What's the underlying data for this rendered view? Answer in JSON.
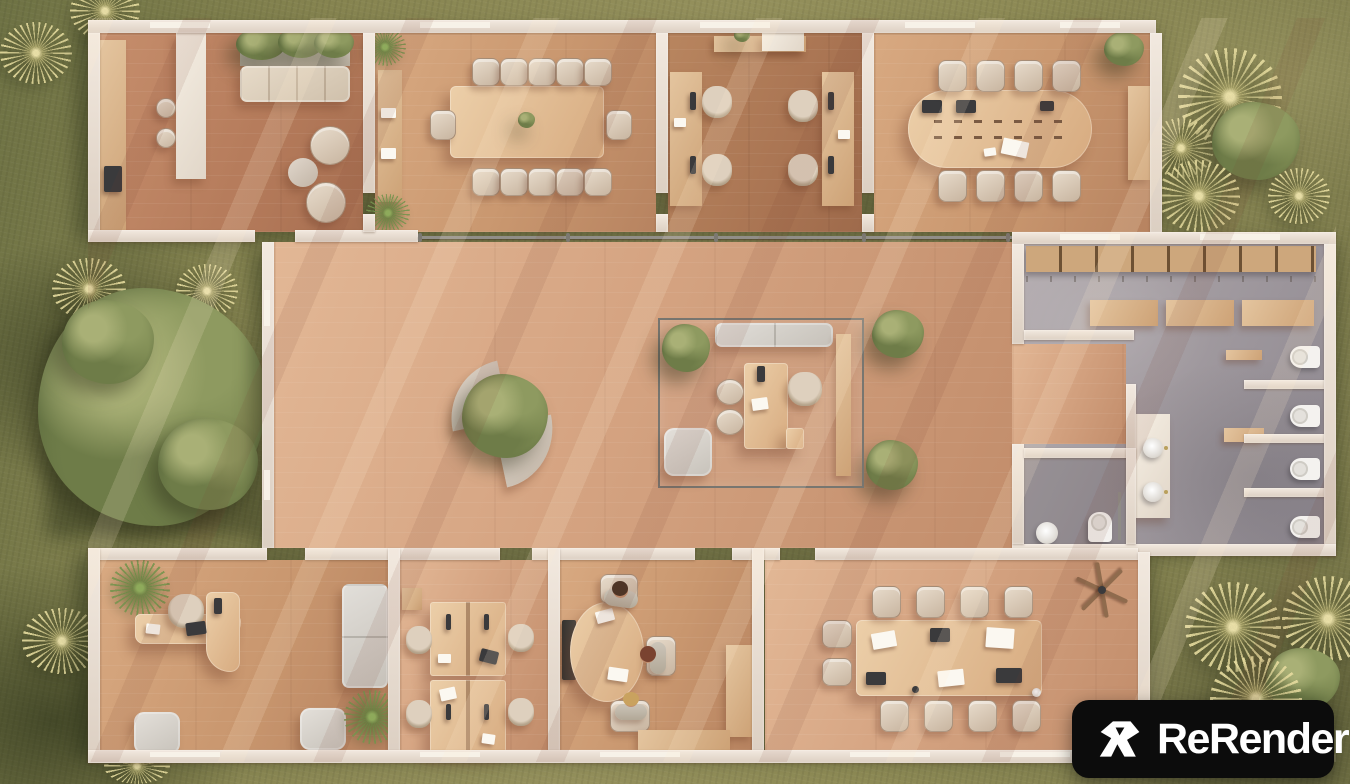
{
  "logo": {
    "text": "ReRender",
    "icon": "rerender-mark",
    "bg": "#0c0c0c",
    "fg": "#ffffff"
  },
  "scene": {
    "type": "3d-floorplan-render",
    "setting": "top-down aerial render of a single-storey office building on an olive-green lawn, warm low sun from the north-east casting long diagonal shadows",
    "rooms": [
      {
        "id": "kitchen-lounge",
        "position": "north-west",
        "furniture": [
          "kitchen counter with cooktop",
          "white island with 2 bar stools",
          "planter box with greenery",
          "4-seat bench sofa",
          "2 round lounge chairs",
          "round coffee table"
        ]
      },
      {
        "id": "large-conference-room",
        "position": "north",
        "furniture": [
          "12-seat rectangular wood table with plant centerpiece",
          "sideboard with decor",
          "2 corner palms"
        ]
      },
      {
        "id": "workstation-office-north",
        "position": "north-center",
        "furniture": [
          "2 wall-mounted long desks",
          "4 monitors",
          "4 task chairs",
          "credenza with plant and board"
        ]
      },
      {
        "id": "oval-meeting-room",
        "position": "north-east",
        "furniture": [
          "8-seat oval table",
          "2 laptops",
          "papers",
          "corner plant",
          "wall credenza"
        ]
      },
      {
        "id": "locker-room",
        "position": "east-wing-north",
        "furniture": [
          "wooden locker cubbies",
          "3 wooden benches",
          "wall mirror"
        ]
      },
      {
        "id": "restroom",
        "position": "east-wing",
        "furniture": [
          "4 toilet stalls with partitions",
          "double-sink vanity",
          "2 small benches"
        ]
      },
      {
        "id": "accessible-wc",
        "position": "east-wing-south",
        "furniture": [
          "toilet",
          "washbasin"
        ]
      },
      {
        "id": "open-hall",
        "position": "center",
        "furniture": [
          "pinwheel fan benches around indoor tree",
          "2 planter trees",
          "glass partition rail"
        ]
      },
      {
        "id": "glass-executive-office",
        "position": "center",
        "furniture": [
          "L-shaped desk",
          "executive chair",
          "2 guest stools",
          "sofa",
          "side bench",
          "lounge chair",
          "potted plant"
        ]
      },
      {
        "id": "executive-office-sw",
        "position": "south-west",
        "furniture": [
          "curved L desk with chair, laptop and monitor",
          "sofa",
          "2 armchairs",
          "2 palms"
        ]
      },
      {
        "id": "workstation-office-south",
        "position": "south-center",
        "furniture": [
          "2 face-to-face desk clusters",
          "4 task chairs",
          "monitors",
          "sideboard"
        ]
      },
      {
        "id": "round-meeting-room",
        "position": "south-center",
        "furniture": [
          "round table with papers",
          "3 seated people",
          "wall display",
          "L-shaped bench"
        ]
      },
      {
        "id": "conference-room-south",
        "position": "south-east",
        "furniture": [
          "10-seat long table",
          "3 laptops",
          "papers",
          "ceiling fan"
        ]
      }
    ],
    "people": [
      {
        "location": "round-meeting-room",
        "hair": "dark brown"
      },
      {
        "location": "round-meeting-room",
        "hair": "auburn"
      },
      {
        "location": "round-meeting-room",
        "hair": "blond"
      }
    ],
    "flora": [
      "large broadleaf tree west of hall",
      "yucca tufts north-west corner",
      "yucca cluster north-east",
      "yucca cluster south-east",
      "indoor palms and planter trees"
    ]
  },
  "palette": {
    "grass": "#8a8753",
    "grass_dark": "#55603a",
    "wood_floor": "#d2a07f",
    "wood_light": "#e6c29e",
    "wall": "#eae0d6",
    "concrete": "#a39da1",
    "furniture_beige": "#d9cabb",
    "sofa_gray": "#d8d5d0",
    "foliage": "#76834d",
    "logo_bg": "#0c0c0c",
    "logo_fg": "#ffffff"
  }
}
